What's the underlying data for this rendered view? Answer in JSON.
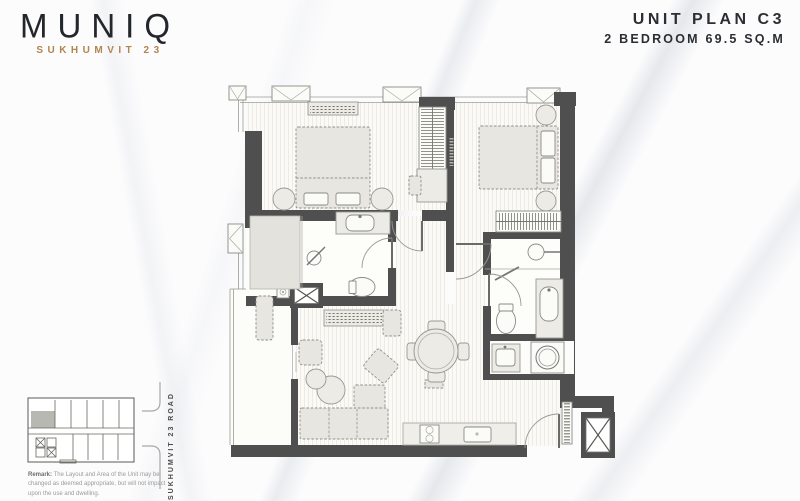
{
  "brand": {
    "name": "MUNIQ",
    "subtitle": "SUKHUMVIT 23",
    "name_color": "#23262b",
    "subtitle_color": "#b0854f"
  },
  "unit_plan": {
    "title": "UNIT PLAN C3",
    "subtitle": "2 BEDROOM 69.5 SQ.M",
    "title_color": "#2b2e33"
  },
  "key_plan": {
    "road_label": "SUKHUMVIT 23 ROAD",
    "highlight_color": "#b8b8b2"
  },
  "remark": {
    "label": "Remark:",
    "text": " The Layout and Area of the Unit may be changed as deemed appropriate, but will not impact upon the use and dwelling."
  },
  "floor_plan": {
    "wall_color": "#4f4f4f",
    "furniture_fill": "#e7e6e0",
    "floor_stripe_color": "#eae8e1",
    "elements": [
      "window-marker",
      "air-conditioner-unit",
      "double-bed",
      "nightstand",
      "wardrobe",
      "desk-and-chair",
      "shower",
      "shower-head",
      "washbasin-vanity",
      "toilet",
      "door-swing",
      "dining-table-4-chairs",
      "l-shaped-sofa",
      "coffee-tables",
      "armchair",
      "lounge-pouf",
      "tv-console",
      "kitchen-counter",
      "stove-2-burners",
      "kitchen-sink",
      "washing-machine",
      "service-shaft-x",
      "balcony-planter",
      "entrance-door",
      "sliding-balcony-door"
    ]
  }
}
